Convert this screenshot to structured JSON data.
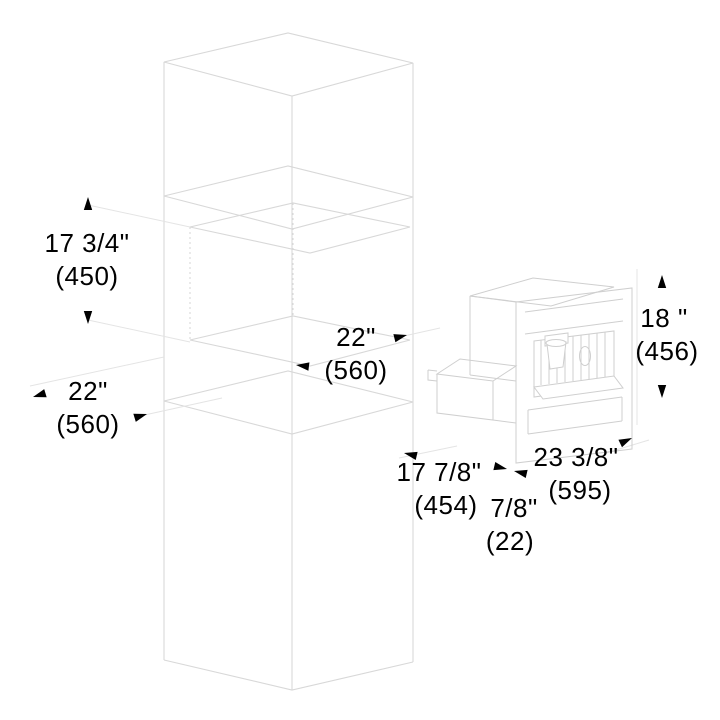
{
  "diagram": {
    "kind": "built-in appliance niche installation drawing",
    "colors": {
      "background": "#ffffff",
      "cabinet_line": "#d8d8d8",
      "appliance_line": "#cfcfcf",
      "extension_line": "#e4e4e4",
      "dimension_ink": "#010101"
    },
    "dims": {
      "niche_height": {
        "inches": "17 3/4\"",
        "mm": "(450)"
      },
      "niche_depth": {
        "inches": "22\"",
        "mm": "(560)"
      },
      "niche_width": {
        "inches": "22\"",
        "mm": "(560)"
      },
      "appliance_height": {
        "inches": "18 \"",
        "mm": "(456)"
      },
      "appliance_width": {
        "inches": "23 3/8\"",
        "mm": "(595)"
      },
      "appliance_depth": {
        "inches": "17 7/8\"",
        "mm": "(454)"
      },
      "front_clearance": {
        "inches": "7/8\"",
        "mm": "(22)"
      }
    }
  }
}
